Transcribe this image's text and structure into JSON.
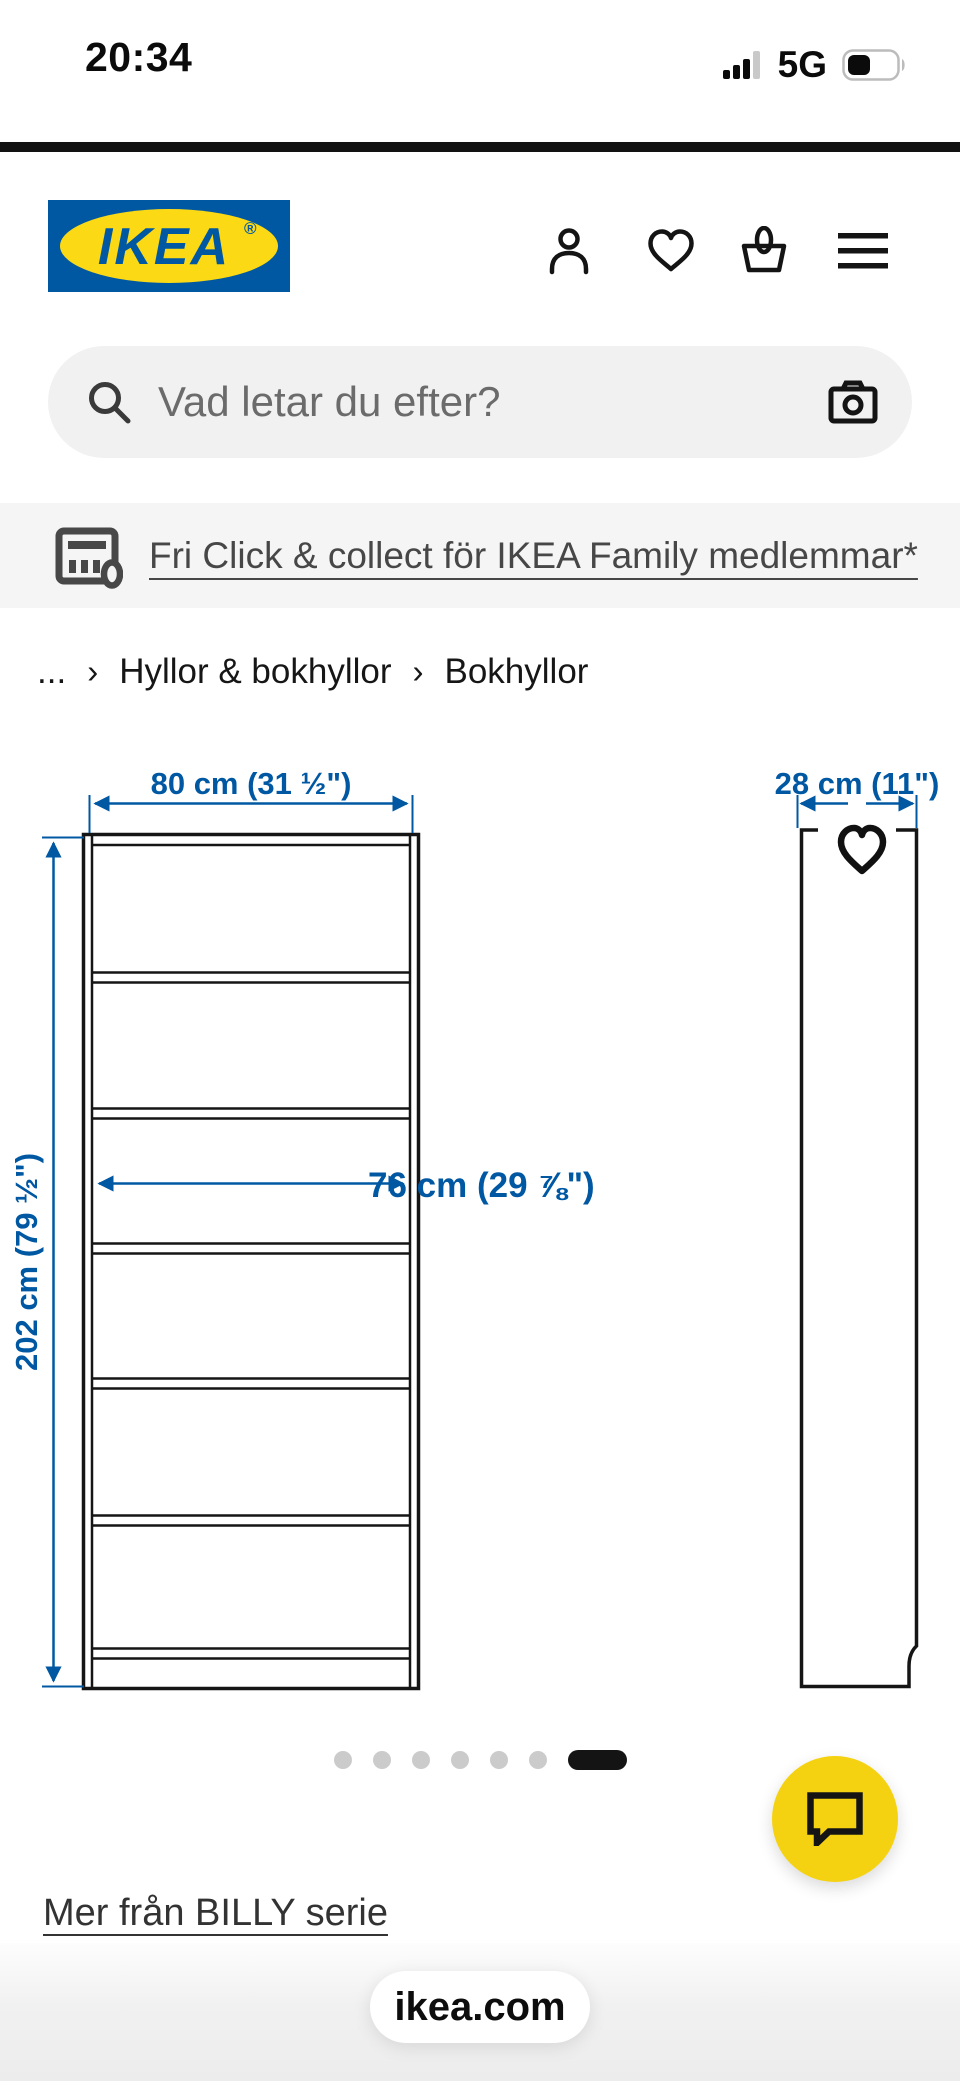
{
  "status_bar": {
    "time": "20:34",
    "network": "5G"
  },
  "header": {
    "logo_text": "IKEA",
    "registered_mark": "®"
  },
  "search": {
    "placeholder": "Vad letar du efter?"
  },
  "promo_banner": {
    "link_text": "Fri Click & collect för IKEA Family medlemmar*"
  },
  "breadcrumb": {
    "ellipsis": "...",
    "separator": "›",
    "items": [
      "Hyllor & bokhyllor",
      "Bokhyllor"
    ]
  },
  "product_diagram": {
    "width_label": "80 cm (31 ½\")",
    "height_label": "202 cm (79 ½\")",
    "inner_width_label": "76 cm (29 ⅞\")",
    "depth_label": "28 cm (11\")",
    "compartments": 6
  },
  "carousel": {
    "slides": 7,
    "active_slide": 7
  },
  "series_link": {
    "label": "Mer från BILLY serie"
  },
  "footer": {
    "site_label": "ikea.com"
  },
  "colors": {
    "ikea_blue": "#0058A3",
    "ikea_yellow": "#FBD914",
    "dimension_blue": "#0058A3",
    "chat_yellow": "#F5D211",
    "active_dot": "#141414",
    "inactive_dot": "#CBCBCB"
  }
}
